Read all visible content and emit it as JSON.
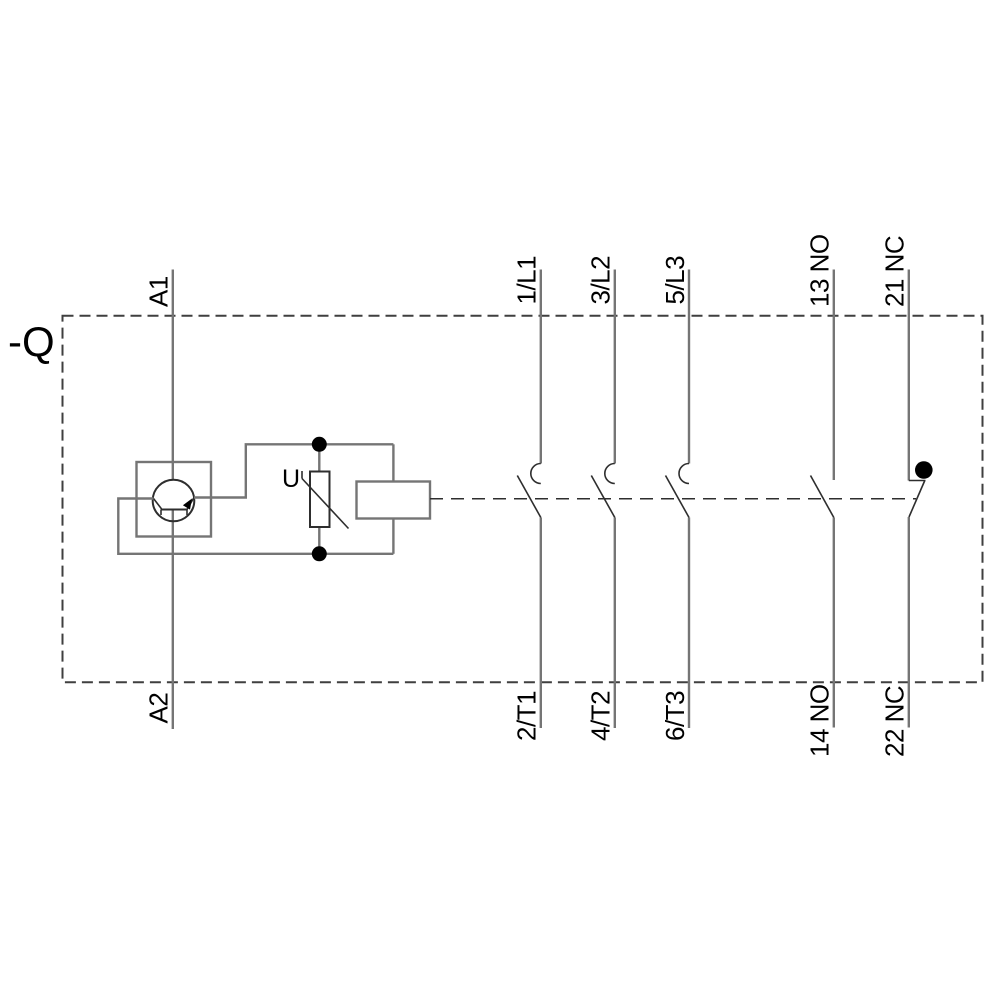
{
  "diagram": {
    "device_tag": "-Q",
    "coil": {
      "terminal_top": "A1",
      "terminal_bottom": "A2",
      "suppressor_label": "U"
    },
    "main_poles": [
      {
        "top": "1/L1",
        "bottom": "2/T1"
      },
      {
        "top": "3/L2",
        "bottom": "4/T2"
      },
      {
        "top": "5/L3",
        "bottom": "6/T3"
      }
    ],
    "aux_contacts": [
      {
        "top": "13 NO",
        "bottom": "14 NO"
      },
      {
        "top": "21 NC",
        "bottom": "22 NC"
      }
    ],
    "colors": {
      "background": "#ffffff",
      "wire": "#757575",
      "detail": "#2e2e2e",
      "border": "#3f3f3f",
      "text": "#000000",
      "node": "#000000"
    }
  }
}
